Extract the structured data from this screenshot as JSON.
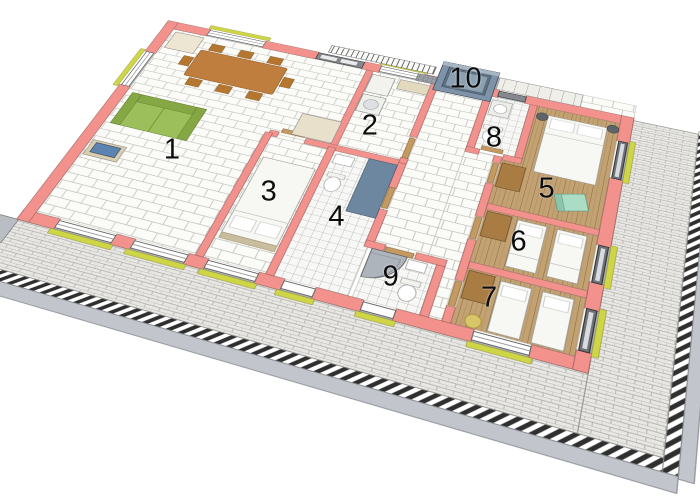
{
  "rooms": [
    {
      "label": "1",
      "u": 140,
      "v": 215
    },
    {
      "label": "2",
      "u": 322,
      "v": 118
    },
    {
      "label": "3",
      "u": 256,
      "v": 238
    },
    {
      "label": "4",
      "u": 330,
      "v": 248
    },
    {
      "label": "5",
      "u": 515,
      "v": 150
    },
    {
      "label": "6",
      "u": 502,
      "v": 224
    },
    {
      "label": "7",
      "u": 490,
      "v": 296
    },
    {
      "label": "8",
      "u": 450,
      "v": 95
    },
    {
      "label": "9",
      "u": 400,
      "v": 300
    },
    {
      "label": "10",
      "u": 400,
      "v": 14
    }
  ],
  "palette": {
    "wall_pink": "#F3928D",
    "wall_gray": "#A8ADB5",
    "floor_tile": "#FBFBF8",
    "grout": "#C9C9C4",
    "wood": "#C2A172",
    "wood_line": "#8A6F42",
    "terrace": "#E8E7E3",
    "sofa_green": "#9CBF5B",
    "table_brown": "#C07E3E",
    "door_tan": "#C49A62",
    "sill_yellow": "#CFD645",
    "entry_blue": "#7E93A8",
    "teal_chair": "#ABDCC6",
    "tv_blue": "#5B84B0"
  }
}
